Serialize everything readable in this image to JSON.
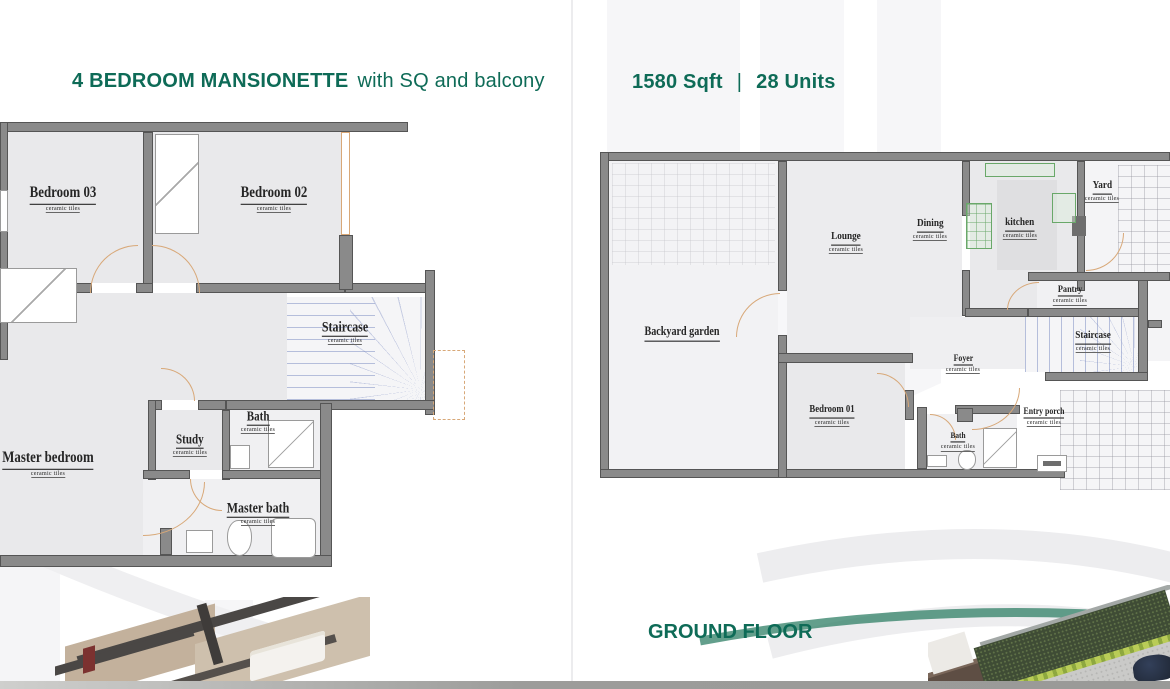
{
  "brochure": {
    "left_panel": {
      "title_bold": "4 BEDROOM MANSIONETTE",
      "title_tail": "with SQ and balcony",
      "rooms": [
        {
          "name": "Bedroom 03",
          "sub": "ceramic tiles"
        },
        {
          "name": "Bedroom 02",
          "sub": "ceramic tiles"
        },
        {
          "name": "Staircase",
          "sub": "ceramic tiles"
        },
        {
          "name": "Bath",
          "sub": "ceramic tiles"
        },
        {
          "name": "Study",
          "sub": "ceramic tiles"
        },
        {
          "name": "Master bedroom",
          "sub": "ceramic tiles"
        },
        {
          "name": "Master bath",
          "sub": "ceramic tiles"
        }
      ]
    },
    "right_panel": {
      "area": "1580 Sqft",
      "divider": "|",
      "units": "28 Units",
      "floor_label": "GROUND FLOOR",
      "rooms": [
        {
          "name": "Backyard garden",
          "sub": ""
        },
        {
          "name": "Lounge",
          "sub": "ceramic tiles"
        },
        {
          "name": "Dining",
          "sub": "ceramic tiles"
        },
        {
          "name": "kitchen",
          "sub": "ceramic tiles"
        },
        {
          "name": "Yard",
          "sub": "ceramic tiles"
        },
        {
          "name": "Pantry",
          "sub": "ceramic tiles"
        },
        {
          "name": "Staircase",
          "sub": "ceramic tiles"
        },
        {
          "name": "Foyer",
          "sub": "ceramic tiles"
        },
        {
          "name": "Bedroom 01",
          "sub": "ceramic tiles"
        },
        {
          "name": "Bath",
          "sub": "ceramic tiles"
        },
        {
          "name": "Entry porch",
          "sub": "ceramic tiles"
        }
      ]
    },
    "colors": {
      "heading_green": "#0e6b57",
      "wall_gray": "#8a8a8a",
      "door_tan": "#d8a878",
      "stair_blue": "#8090c4",
      "kitchen_green": "#69a869",
      "floor_gray": "#e9e9eb"
    }
  }
}
